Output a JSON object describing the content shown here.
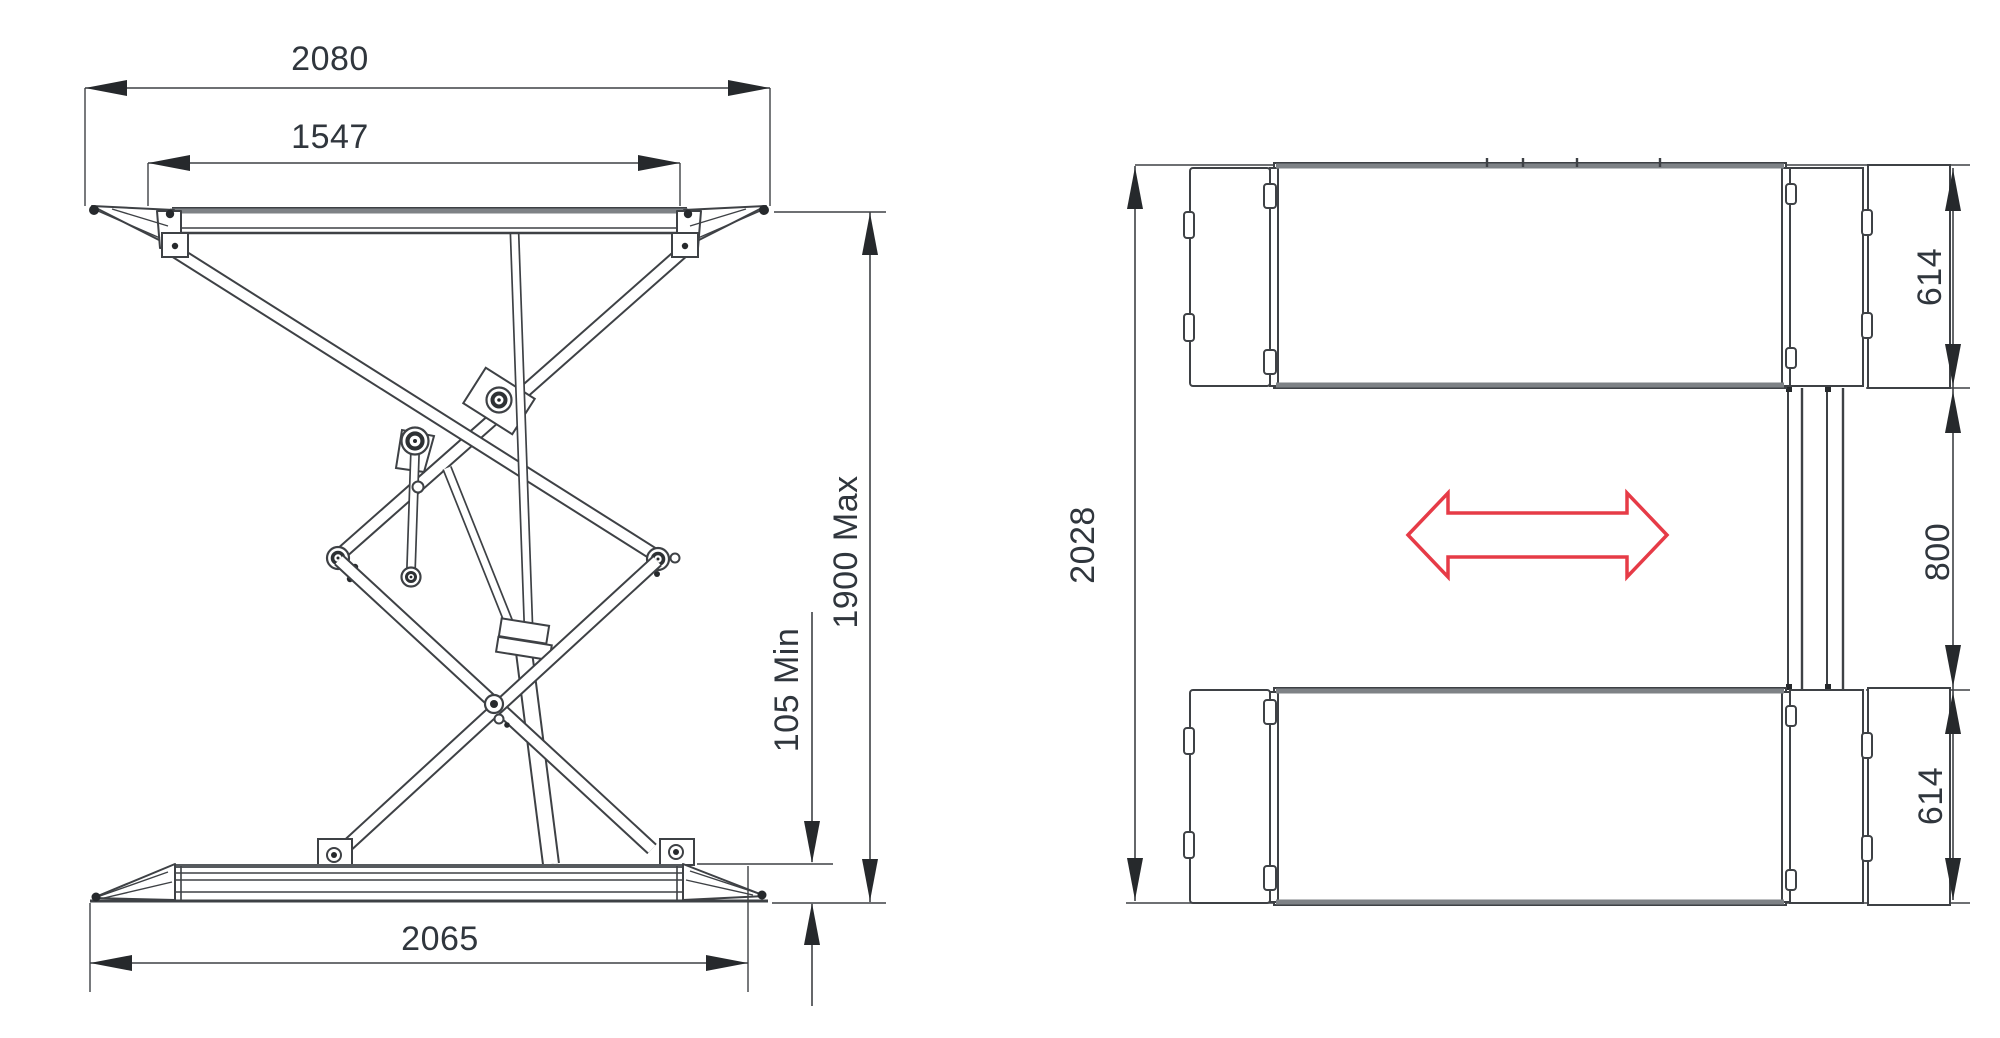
{
  "drawing": {
    "type": "technical-dimension-drawing",
    "subject": "double-scissor car lift, side elevation and plan view",
    "side_view": {
      "top_overall": "2080",
      "platform_inner": "1547",
      "raised_height": "1900 Max",
      "lowered_height": "105 Min",
      "base_length": "2065"
    },
    "top_view": {
      "overall_length": "2028",
      "platform_width_top": "614",
      "drive_through_gap": "800",
      "platform_width_bottom": "614"
    },
    "icons": {
      "drive_direction": "double-headed-horizontal-arrow"
    },
    "colors": {
      "line": "#3e4145",
      "thick_edge": "#7e8286",
      "dim_text": "#30363d",
      "arrow_fill": "#26292c",
      "accent_red": "#e63b47",
      "background": "#ffffff"
    }
  }
}
